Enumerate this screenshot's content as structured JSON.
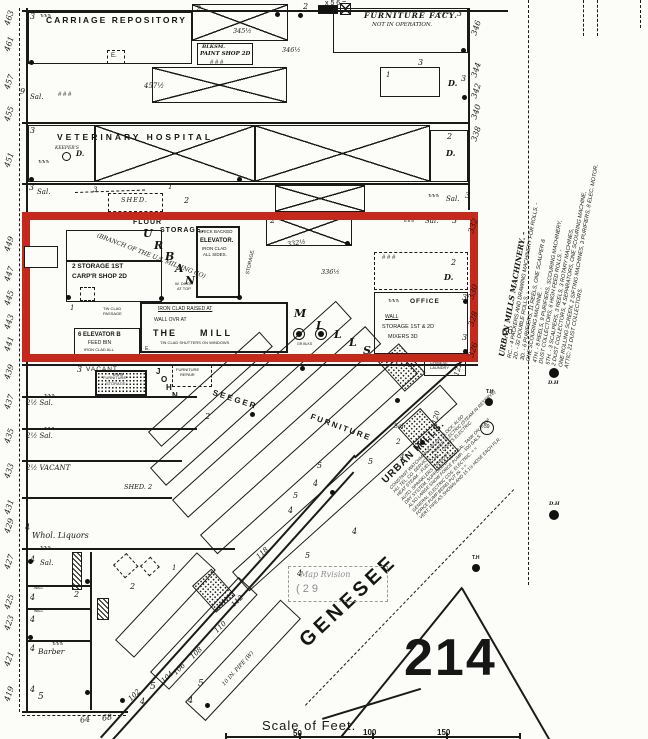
{
  "colors": {
    "highlight_red": "#c5291b",
    "ink": "#1a1a1a",
    "paper": "#fcfcf9",
    "faint_gray": "#8a8f94"
  },
  "marks": {
    "f1": "1",
    "f2": "2",
    "f3": "3",
    "f4": "4",
    "f5": "5",
    "f6": "6",
    "f7": "7",
    "f9": "9",
    "sal": "Sal.",
    "d": "D.",
    "e": "E.",
    "tick": "ъъъ",
    "hash": "# # #",
    "th": "T.H",
    "dh": "D.H",
    "corner": "x 5 6 =",
    "wall": "WALL"
  },
  "left_numbers": [
    "463",
    "461",
    "457",
    "455",
    "451",
    "449",
    "447",
    "445",
    "443",
    "441",
    "439",
    "437",
    "435",
    "433",
    "431",
    "429",
    "427",
    "425",
    "423",
    "421",
    "419"
  ],
  "right_numbers": [
    "346",
    "344",
    "342",
    "340",
    "338",
    "332",
    "330",
    "328",
    "326"
  ],
  "street_numbers": [
    "102",
    "104",
    "106",
    "108",
    "110",
    "112",
    "118",
    "120",
    "122"
  ],
  "top_band": {
    "carriage_repository": "CARRIAGE  REPOSITORY",
    "blksm": "BLKSM.",
    "paint_shop": "PAINT SHOP 2D",
    "n3456": "345½",
    "n3463": "346½",
    "n457h": "457½",
    "furniture_facy": "FURNITURE FACY.",
    "not_in_operation": "NOT IN OPERATION."
  },
  "vet_band": {
    "veterinary_hospital": "VETERINARY    HOSPITAL",
    "keepers": "KEEPER'S",
    "shed": "SHED."
  },
  "mills": {
    "flour": "FLOUR",
    "storage": "STORAGE.",
    "branch": "(BRANCH OF THE U.S. MILLING CO)",
    "u": "U",
    "r": "R",
    "b": "B",
    "a": "A",
    "n": "N",
    "m": "M",
    "i": "I",
    "l": "L",
    "s": "S",
    "brick": "BRICK BACKED",
    "elevator": "ELEVATOR.",
    "iron_clad": "IRON CLAD",
    "all_sides": "ALL SIDES.",
    "storage1": "2 STORAGE 1ST",
    "carp": "CARP'R SHOP 2D",
    "wdoor1": "W. DOOR",
    "wdoor2": "AT TOP",
    "elev6": "6 ELEVATOR B",
    "feed": "FEED BIN",
    "ironall": "IRON CLAD ALL",
    "tin1": "TIN CLAD",
    "tin2": "PASSAGE",
    "raised": "IRON CLAD RAISED AT",
    "wallovr": "WALL OVR AT",
    "the": "THE",
    "mill": "MILL",
    "shutters": "TIN CLAD SHUTTERS ON WINDOWS",
    "grblks": "GR BLKS",
    "office": "OFFICE",
    "stor12": "STORAGE 1ST & 2D",
    "mixers": "MIXERS 3D",
    "n332h": "332½",
    "n336h": "336½",
    "n66": "66"
  },
  "machinery_note": {
    "heading": "URBAN MILLS MACHINERY. -",
    "lines": [
      "RC. - 4 PACKERS AND DRAWING MACHINERY FOR ROLLS. -",
      "2D. - 32 DOUBLE ROLLS. -",
      "3D. - 6 PURIFIERS, 11 REELS, ONE SCALPER &",
      "ONE SCOURING MACHINE. -",
      "4TH. - 8 REELS, 9 PURIFIERS, SCOURING MACHINERY,",
      "DUST COLLECTORS, 6 HIGH FEED ROLLS. -",
      "5TH. - 3 SCALPERS, 3 REELS, 3 ROTARY MACHINES,",
      "2 DUST COLLECTORS, 4 SEPARATORS, ONE SCOURING MACHINE,",
      "ONE ROLLING SCREEN, 2 SIFTING MACHINES, 3 PURIFIERS, 8 ELEC. MOTOR.",
      "ATTIC: 21 DUST COLLECTORS."
    ]
  },
  "watchman_note": {
    "heading": "URBAN MILLS.",
    "lines": [
      "CONSTANT WATCHMAN & WLER. CLOCK; ALSO",
      "HU. TEL. CO. SERVICE. - POWER ELECTRIC (STEAM IN RESERVE)",
      "HEAT STEAM. - FUEL COAL. - LIGHTS ELECTRIC.",
      "AUTO. SPRINKLERS THRUOUT.",
      "DRY SYSTEM, SUPPLIED BY 8500 GAL. TANK ON ROOF",
      "ALSO LARGE SNOW FORCE PUMP. - 500 GALS.",
      "GENERAL ELECTRIC COS. ELECTRIC. = =",
      "FORCE PUMP BEING PUT IN. = =",
      "VERT. PIPE AS SHOWN AND 15 1½ HOSE EACH FLR."
    ]
  },
  "lower": {
    "vacant": "VACANT",
    "j": "J",
    "o": "O",
    "h": "H",
    "n": "N",
    "seeger": "S E E G E R",
    "furniture": "FURNITURE",
    "furn": "FURNITURE",
    "stor": "STORAGE",
    "repair": "REPAIR",
    "sal25": "2½ Sal.",
    "vacant25": "2½ VACANT",
    "shed2": "SHED. 2",
    "whol": "Whol. Liquors",
    "barber": "Barber",
    "chinese1": "CHINESE",
    "chinese2": "LAUNDRY",
    "c39": "39",
    "sal_small": "Sal."
  },
  "bottom": {
    "genesee": "GENESEE",
    "block_number": "214",
    "pipe": "10 IN. PIPE (W)",
    "scale_label": "Scale of Feet.",
    "ticks": [
      "50",
      "100",
      "150"
    ],
    "n64": "64",
    "n68": "68",
    "map_stamp_1": "Map Rvision",
    "map_stamp_2": "( 2 9"
  }
}
